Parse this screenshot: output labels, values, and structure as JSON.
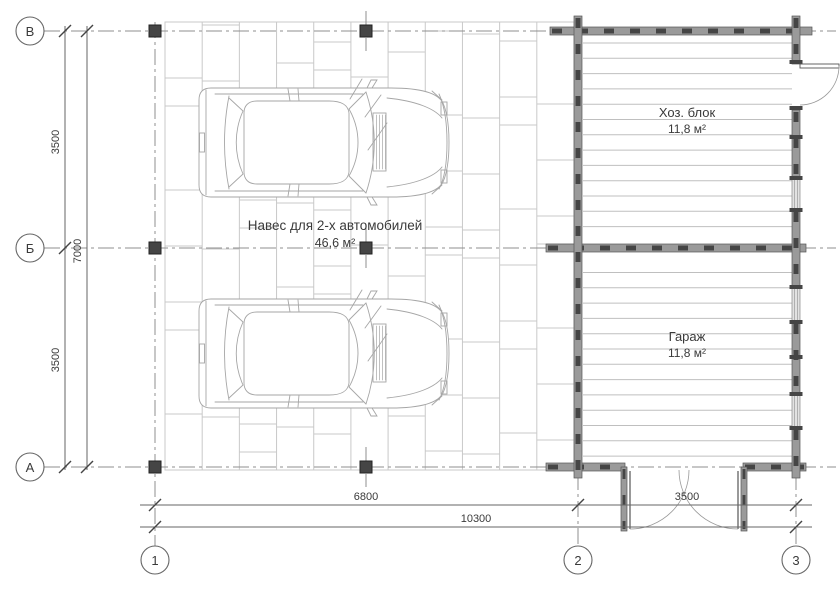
{
  "plan": {
    "canopy": {
      "title": "Навес для 2-х автомобилей",
      "area": "46,6 м²"
    },
    "rooms": [
      {
        "name": "Хоз. блок",
        "area": "11,8 м²"
      },
      {
        "name": "Гараж",
        "area": "11,8 м²"
      }
    ],
    "axes": {
      "rows": [
        "В",
        "Б",
        "А"
      ],
      "cols": [
        "1",
        "2",
        "3"
      ]
    },
    "dims": {
      "left_upper": "3500",
      "left_total": "7000",
      "left_lower": "3500",
      "bottom_left_span": "6800",
      "bottom_right_span": "3500",
      "bottom_total": "10300"
    },
    "colors": {
      "paving": "#c9c9c9",
      "plank": "#bfbfbf",
      "wall_fill": "#9a9a9a",
      "wall_dark": "#454545",
      "wall_edge": "#555555",
      "window_fill": "#e2e2e2",
      "axis": "#8f8f8f",
      "dim": "#666666",
      "text": "#3a3a3a",
      "car": "#a6a6a6"
    }
  }
}
